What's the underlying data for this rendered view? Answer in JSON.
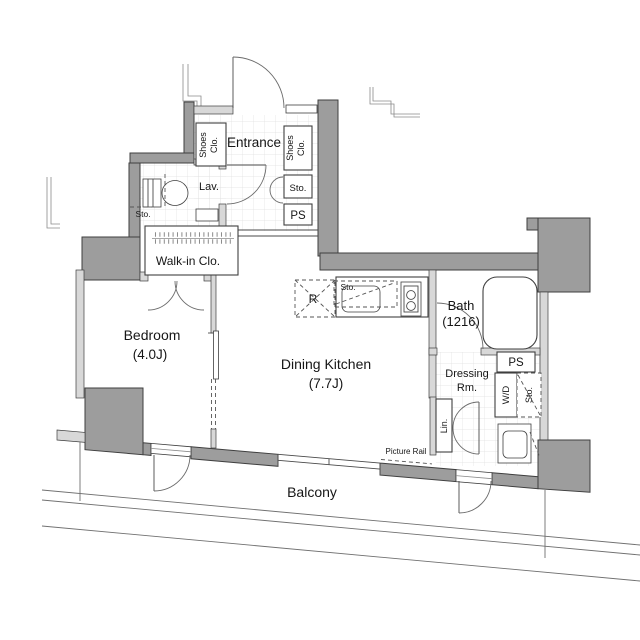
{
  "colors": {
    "bg": "#ffffff",
    "wall-dark": "#9d9d9d",
    "wall-light": "#d8d8d8",
    "line": "#3f3f3f",
    "grid": "#dfdfdf",
    "text": "#161616"
  },
  "labels": {
    "entrance": "Entrance",
    "shoes_line1": "Shoes",
    "shoes_line2": "Clo.",
    "lav": "Lav.",
    "sto": "Sto.",
    "ps": "PS",
    "walkin": "Walk-in Clo.",
    "bedroom_name": "Bedroom",
    "bedroom_size": "(4.0J)",
    "dk_name": "Dining Kitchen",
    "dk_size": "(7.7J)",
    "bath_name": "Bath",
    "bath_size": "(1216)",
    "dressing_line1": "Dressing",
    "dressing_line2": "Rm.",
    "wd": "W/D",
    "lin": "Lin.",
    "fridge": "R",
    "picture_rail": "Picture Rail",
    "balcony": "Balcony"
  }
}
